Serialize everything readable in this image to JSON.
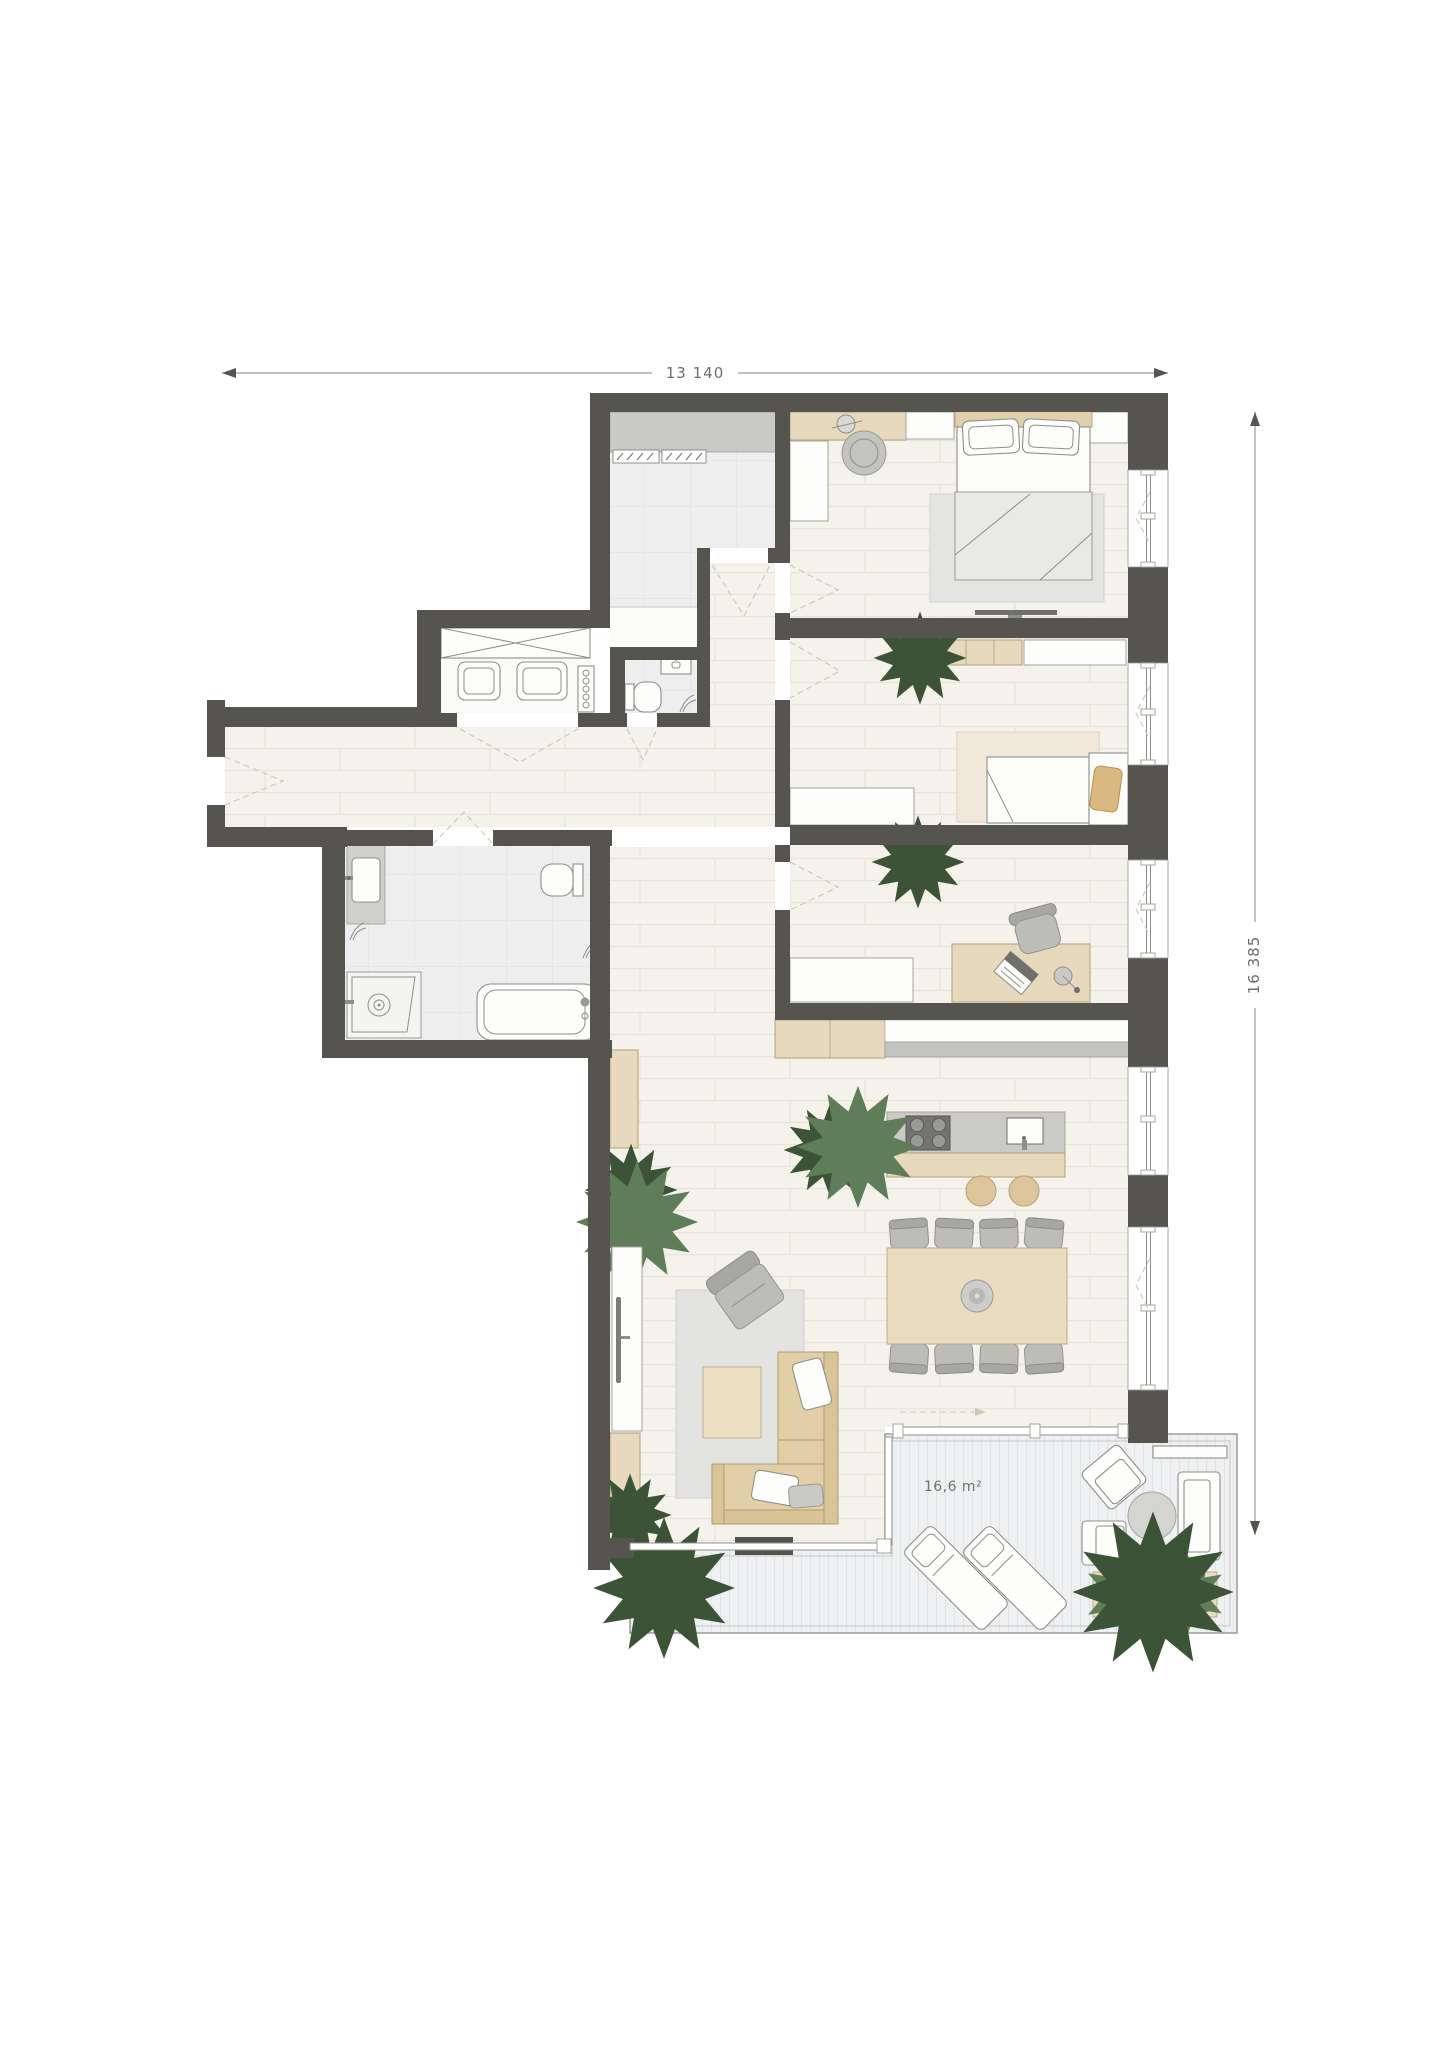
{
  "plan": {
    "type": "apartment-floor-plan",
    "dimension_top_label": "13 140",
    "dimension_right_label": "16 385",
    "terrace_area_label": "16,6 m²"
  },
  "colors": {
    "wall": "#55544e",
    "wood_floor": "#f4f2ea",
    "tile_floor": "#eeeeef",
    "terrace_deck": "#eef0f1",
    "furniture_wood": "#e7d9bd",
    "sofa_beige": "#e3cfa7",
    "furniture_grey": "#bcbcb9",
    "counter_grey": "#cacac7",
    "plant_dark": "#55724f",
    "plant_light": "#9cc093",
    "pillow_tan": "#d9b97f",
    "dimension_text": "#6f6f69"
  },
  "symbols": [
    "double-bed-icon",
    "single-bed-icon",
    "bathtub-icon",
    "shower-icon",
    "toilet-icon",
    "washbasin-icon",
    "washer-icon",
    "dryer-icon",
    "wardrobe-icon",
    "kitchen-island-icon",
    "hob-icon",
    "sink-icon",
    "dining-table-icon",
    "chair-icon",
    "corner-sofa-icon",
    "armchair-icon",
    "coffee-table-icon",
    "tv-icon",
    "plant-icon",
    "lounger-icon",
    "outdoor-sofa-icon",
    "planter-icon",
    "door-swing-icon",
    "window-icon"
  ]
}
